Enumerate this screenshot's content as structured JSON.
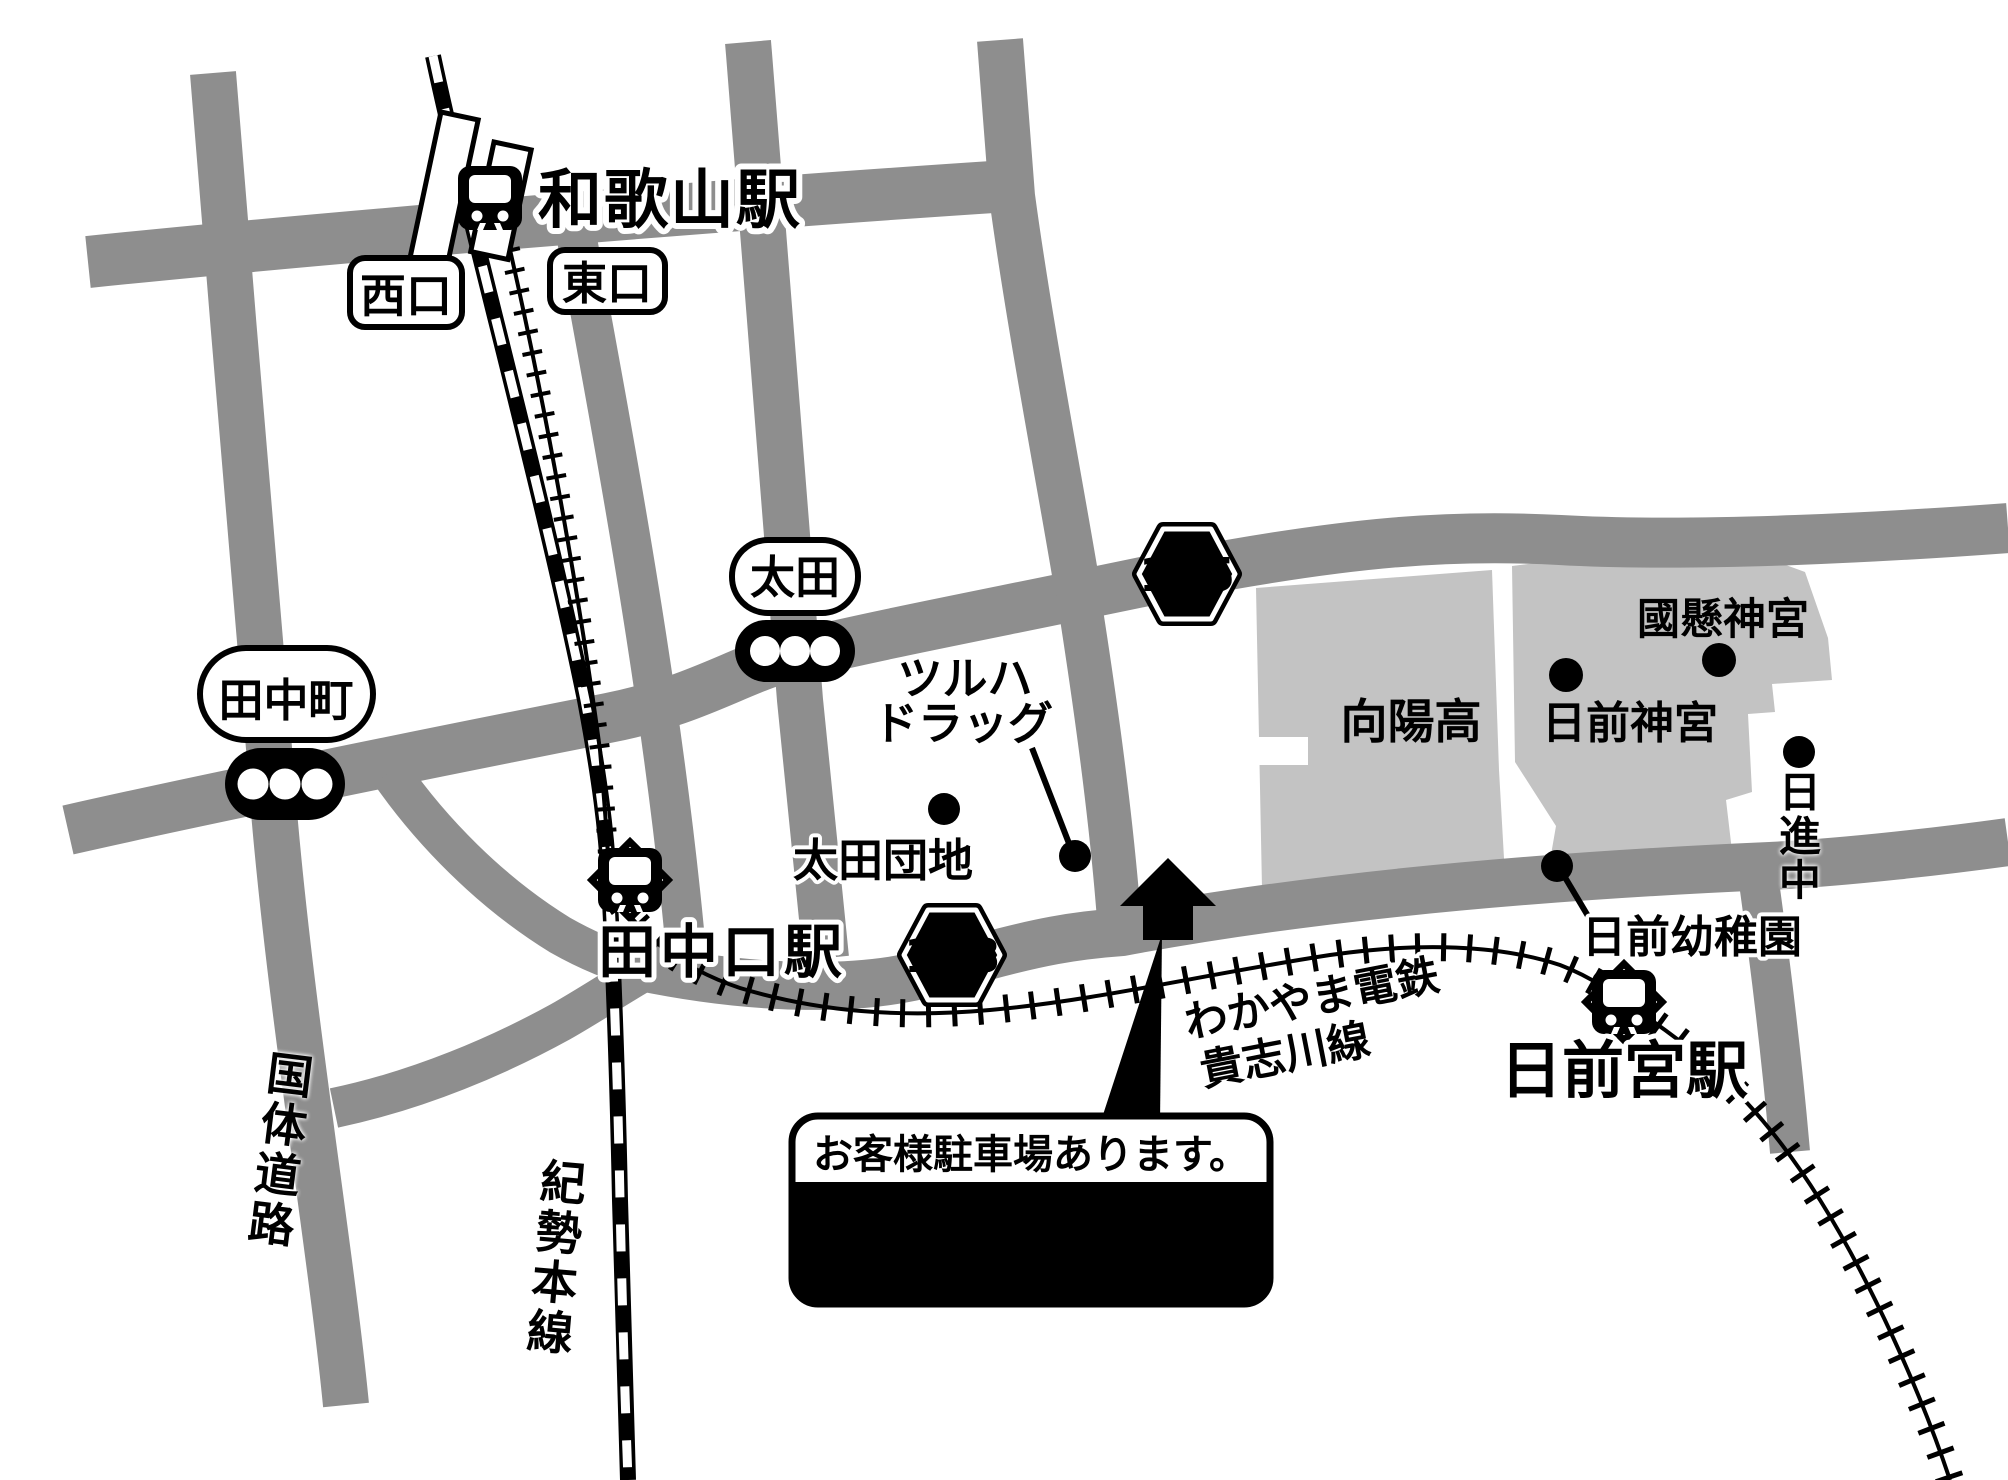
{
  "map": {
    "stations": {
      "wakayama": {
        "name": "和歌山駅",
        "west_exit": "西口",
        "east_exit": "東口"
      },
      "tanakaguchi": {
        "name": "田中口駅"
      },
      "nichizengu": {
        "name": "日前宮駅"
      }
    },
    "signal_intersections": {
      "tanakamachi": "田中町",
      "ota": "太田"
    },
    "route_badges": {
      "r145": "145",
      "r138": "138"
    },
    "railway_lines": {
      "kisei": "紀勢本線",
      "wakayama_dentetsu": "わかやま電鉄",
      "kishigawa": "貴志川線"
    },
    "road_names": {
      "kokutai": "国体道路"
    },
    "pois": {
      "tsuruha_line1": "ツルハ",
      "tsuruha_line2": "ドラッグ",
      "ota_danchi": "太田団地",
      "koyo_high": "向陽高",
      "hinokuma_shrine": "日前神宮",
      "kunikakasu_shrine": "國懸神宮",
      "nisshin_jhs": "日進中",
      "hinokuma_kindergarten": "日前幼稚園"
    },
    "store": {
      "parking_note": "お客様駐車場あります。",
      "name": "和歌山太田店"
    }
  },
  "colors": {
    "road": "#8e8e8e",
    "campus": "#c3c3c3",
    "ink": "#000000",
    "paper": "#ffffff"
  }
}
